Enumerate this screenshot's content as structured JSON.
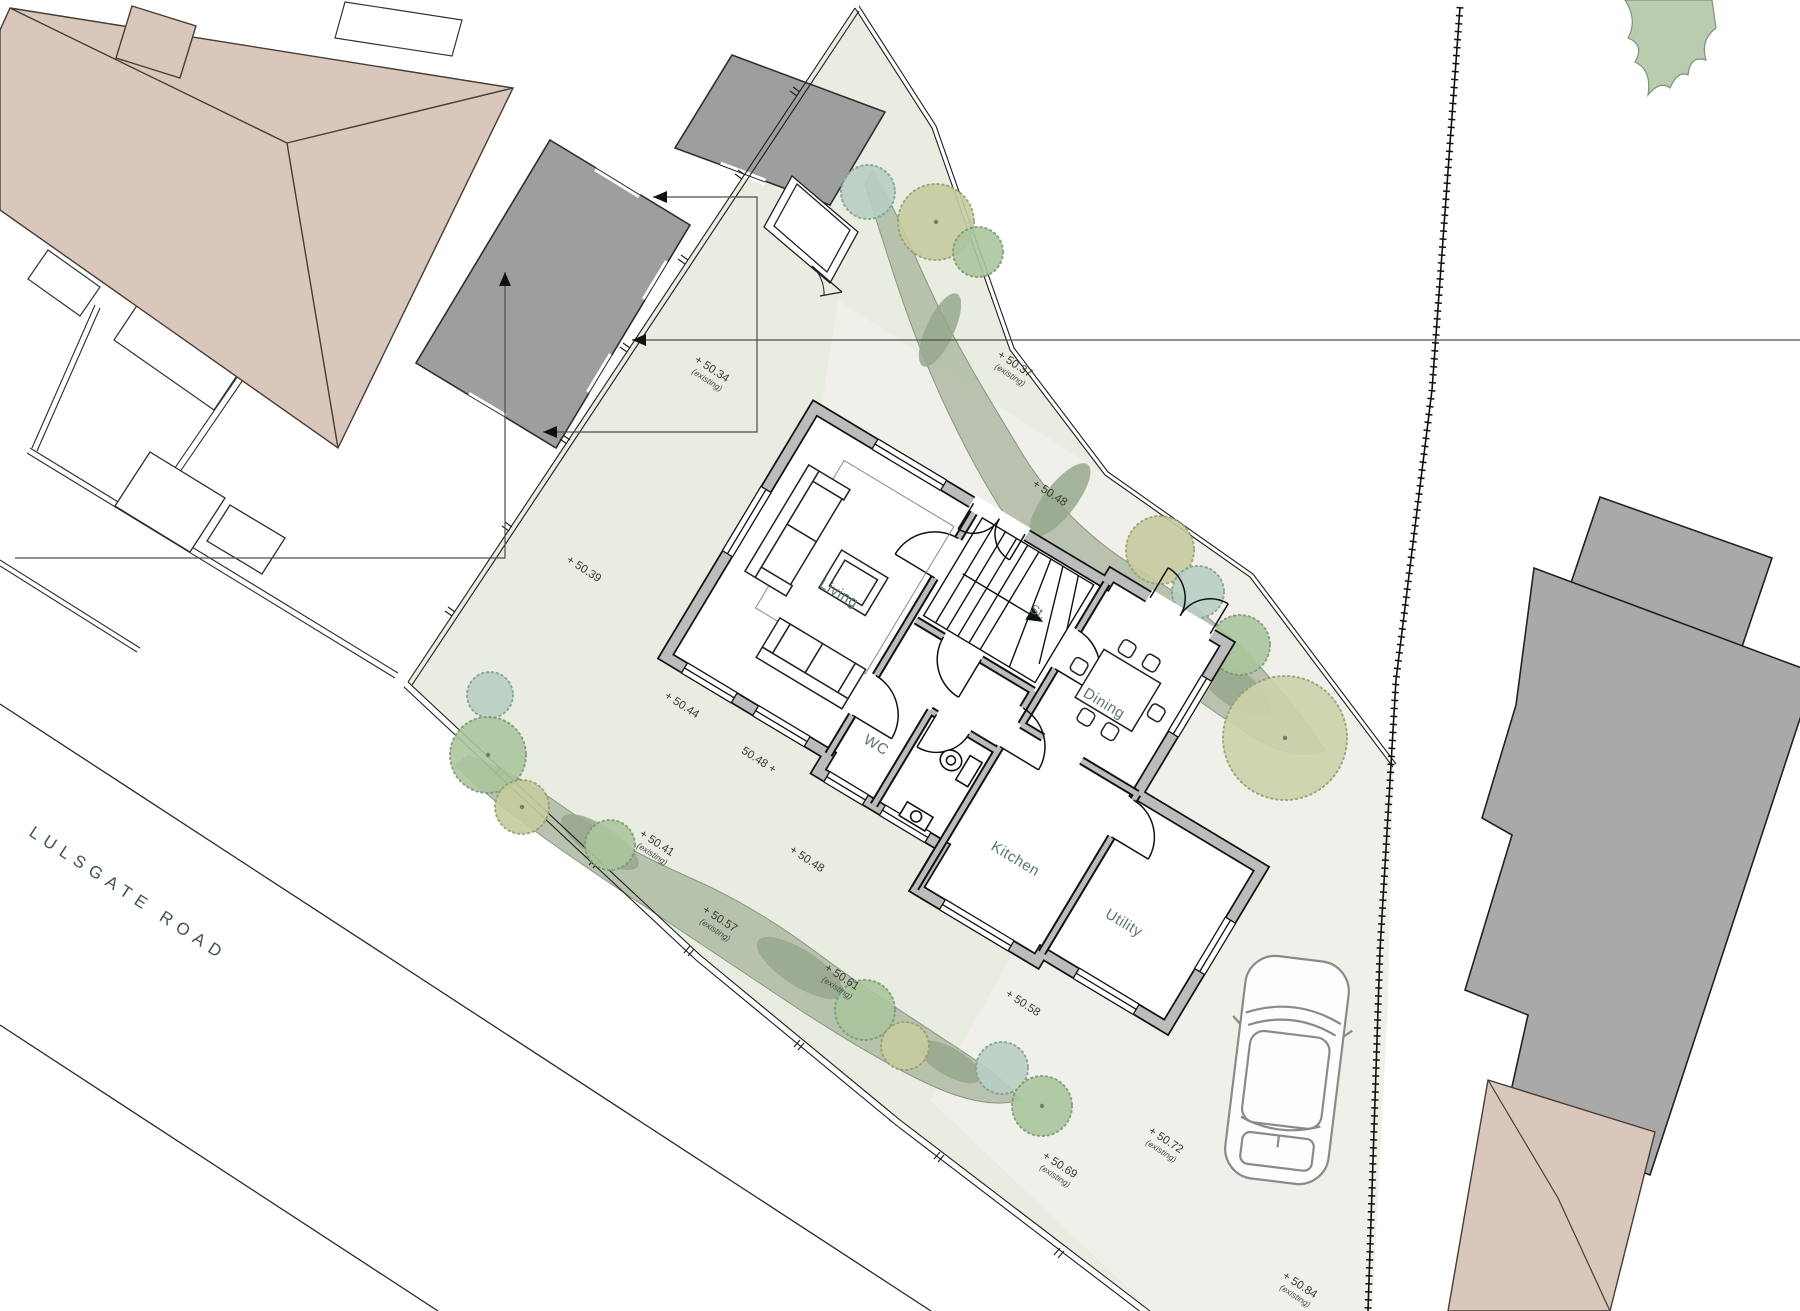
{
  "road": {
    "name": "LULSGATE ROAD"
  },
  "rooms": {
    "living": "Living",
    "stairs": "St.",
    "wc": "WC",
    "kitchen": "Kitchen",
    "utility": "Utility",
    "dining": "Dining"
  },
  "spots": [
    {
      "label": "+ 50.34",
      "sub": "(existing)"
    },
    {
      "label": "+ 50.37",
      "sub": "(existing)"
    },
    {
      "label": "+ 50.48",
      "sub": ""
    },
    {
      "label": "+ 50.39",
      "sub": ""
    },
    {
      "label": "+ 50.44",
      "sub": ""
    },
    {
      "label": "50.48 +",
      "sub": ""
    },
    {
      "label": "+ 50.48",
      "sub": ""
    },
    {
      "label": "+ 50.41",
      "sub": "(existing)"
    },
    {
      "label": "+ 50.57",
      "sub": "(existing)"
    },
    {
      "label": "+ 50.61",
      "sub": "(existing)"
    },
    {
      "label": "+ 50.58",
      "sub": ""
    },
    {
      "label": "+ 50.69",
      "sub": "(existing)"
    },
    {
      "label": "+ 50.72",
      "sub": "(existing)"
    },
    {
      "label": "+ 50.84",
      "sub": "(existing)"
    }
  ],
  "colors": {
    "plot_fill": "#e9ece1",
    "paving": "#f1efe9",
    "hedge": "#b5c0ab",
    "hedge_dark": "#96a88e",
    "roof_tan": "#d8c7ba",
    "building_gray": "#9e9e9e",
    "neighbor_gray": "#a9a9a9",
    "wall_gray": "#bcbcbc",
    "tree_teal": "#b9cfc5",
    "tree_green": "#abc69e",
    "tree_olive": "#c7cba0",
    "tree_pale": "#cdd3ac",
    "corner_veg": "#b9ccb0"
  }
}
